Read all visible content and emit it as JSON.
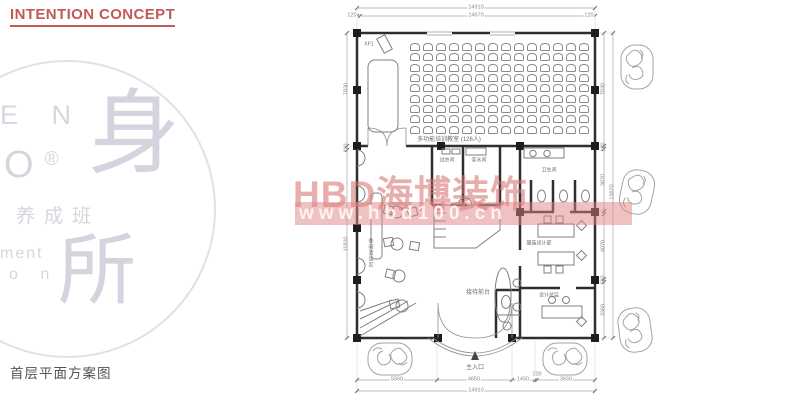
{
  "slide": {
    "title": "INTENTION CONCEPT",
    "caption": "首层平面方案图"
  },
  "logo": {
    "letters_top": "E N",
    "letter_o": "O",
    "reg_mark": "®",
    "cn_small": "养成班",
    "latin_frag1": "ment",
    "latin_frag2": "o n",
    "glyph_main": "身",
    "glyph_sub": "所"
  },
  "watermark": {
    "brand": "HBD海博装饰",
    "url": "www.hbd100.cn"
  },
  "plan": {
    "rooms": {
      "classroom": "多功能培训教室 (126人)",
      "fitting": "试衣间",
      "pantry": "茶水间",
      "toilet": "卫生间",
      "design_dept": "服装设计部",
      "director": "设计总监",
      "reception": "接待前台",
      "lounge": "休闲洽谈区",
      "entrance": "主入口",
      "equip": "XF1"
    },
    "dims": {
      "top_overall": "14910",
      "top_inner": "14670",
      "top_off_left": "120",
      "top_off_right": "120",
      "left_upper": "7830",
      "left_mid": "110",
      "left_lower": "11920",
      "right_upper": "7830",
      "right_gap1": "180",
      "right_sec1": "3870",
      "right_sec2": "4070",
      "right_gap2": "180",
      "right_sec3": "3360",
      "right_overall": "13870",
      "bottom_1": "5060",
      "bottom_2": "4650",
      "bottom_3": "1450",
      "bottom_4": "100",
      "bottom_5": "3650",
      "bottom_overall": "14910"
    },
    "seating": {
      "rows": 9,
      "cols": 14,
      "capacity": 126
    }
  },
  "colors": {
    "accent_red": "#bf5a58",
    "watermark_pink": "#d97474",
    "wall_dark": "#2e2e2e",
    "logo_gray": "#d8d5de"
  }
}
